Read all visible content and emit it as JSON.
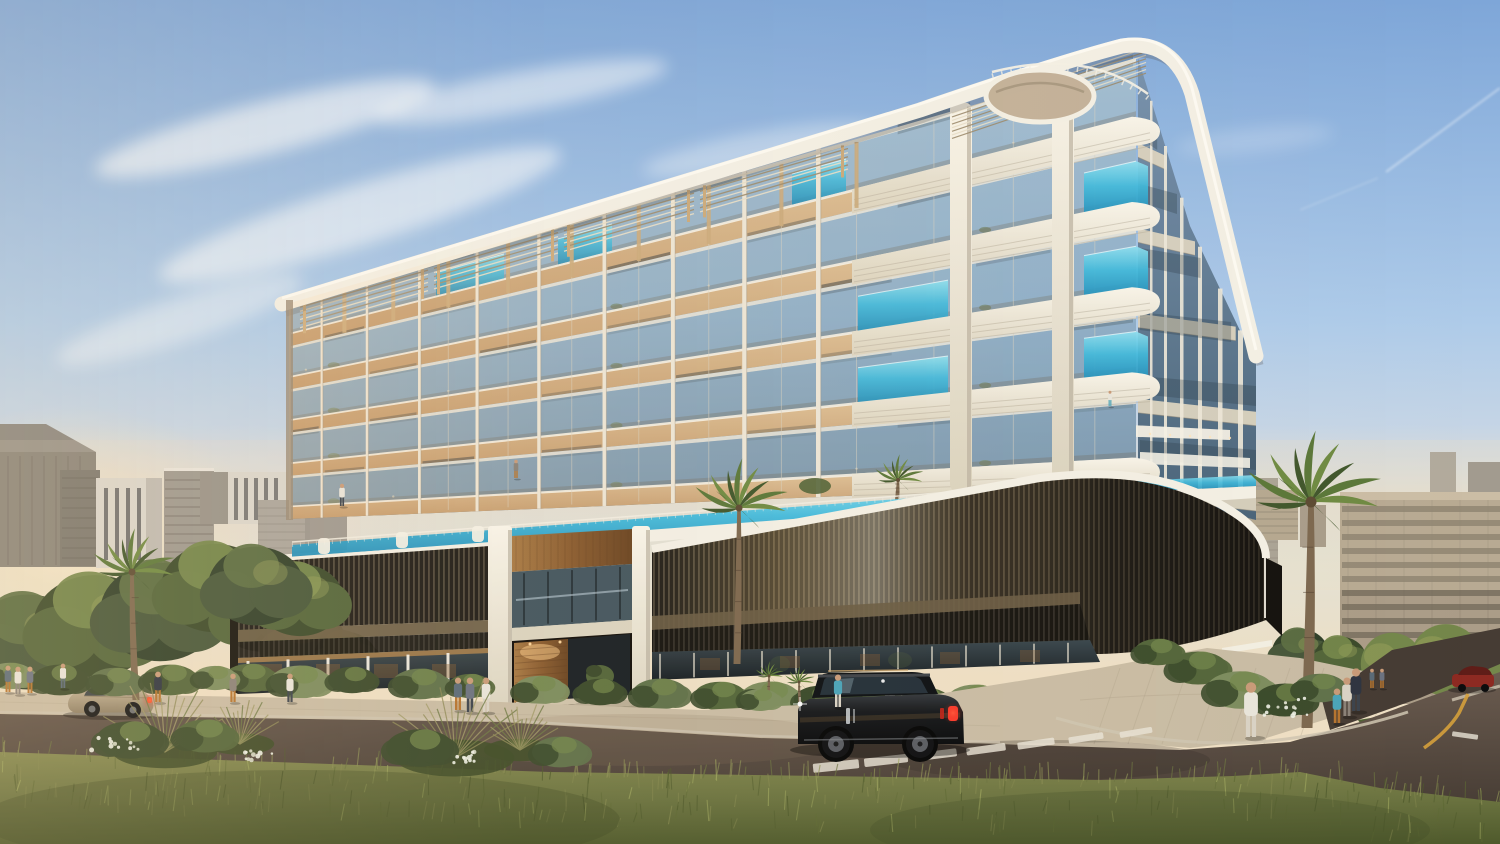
{
  "scene": {
    "type": "architectural-exterior-render",
    "subject": "modern luxury apartment building with balcony pools",
    "setting": "residential street corner, late afternoon sun from the left",
    "sky": "clear blue with thin cirrus clouds and a faint contrail"
  },
  "building": {
    "name": "main-apartment-building",
    "floors_visible": 5,
    "features": [
      "glass-balconies",
      "balcony-plunge-pools",
      "timber-slab-bands",
      "vertical-white-fins",
      "rounded-corner-balconies",
      "rooftop-pergolas",
      "curved-white-roof-canopy",
      "circular-roof-disc",
      "bronze-louvre-podium",
      "rooftop-pool-deck",
      "recessed-timber-entrance"
    ]
  },
  "vehicles": [
    {
      "name": "black-luxury-suv",
      "color": "#111315",
      "lights": "red-taillights-on"
    },
    {
      "name": "beige-wagon",
      "color": "#b9a98d",
      "lights": "red-taillights-on"
    },
    {
      "name": "dark-red-car",
      "color": "#8d2a22"
    }
  ],
  "vegetation": {
    "palm_trees": 4,
    "street_bushes": "dense shrubs with white flowers",
    "foreground": "tall olive-green grass meadow"
  },
  "pedestrians": {
    "count": 17,
    "outfits": [
      "#5a6a78",
      "#8a8178",
      "#c9556a",
      "#4aa3b8",
      "#e8e4da",
      "#6b7280",
      "#b5742f",
      "#2e3440",
      "#d9d2c4",
      "#3c434c"
    ]
  },
  "road": {
    "markings": [
      "white-crosswalk",
      "yellow-center-line",
      "white-stop-dash"
    ],
    "crosswalk_bar_count": 7
  },
  "palette": {
    "sky_top": "#7ea6d8",
    "sky_mid": "#aecbe9",
    "sky_low": "#cfd9e4",
    "sky_haze": "#e3e1d4",
    "sky_warm": "#eedfc4",
    "sun_glow": "#fff3d6",
    "cloud": "#ffffff",
    "skyline_dark": "#716f68",
    "skyline_mid": "#918e87",
    "skyline_light": "#d7d5cf",
    "skyline_side": "#b7b5b0",
    "skyline_win": "#41444a",
    "bg_beige": "#ab9d88",
    "bg_beige_dark": "#8e8171",
    "bg_win": "#564f42",
    "bg_glow": "#c8914d",
    "tree_dark": "#3b4a2b",
    "tree_mid": "#53653a",
    "tree_light": "#74874b",
    "tree_warm": "#9aa25c",
    "palm_dark": "#41572c",
    "palm_mid": "#5b7739",
    "palm_light": "#6f8a42",
    "palm_trunk": "#7d684f",
    "glass_hi": "#9db8d0",
    "glass": "#7da1c0",
    "glass_lo": "#58748c",
    "balustrade": "#a9c3d4",
    "wood_hi": "#e7cda4",
    "wood_lo": "#bd9468",
    "wood_soffit": "#c9a87a",
    "fin": "#ece6d8",
    "cream": "#f3efe4",
    "cream_shade": "#dbd3bf",
    "groove": "#b7ae9c",
    "pool_light": "#8fe0f0",
    "pool_aqua": "#3fb9dc",
    "pool_deep": "#1f8cb8",
    "louvre_dark": "#201d18",
    "louvre_line": "#7d7159",
    "louvre_dark2": "#15130f",
    "louvre_line2": "#4e4840",
    "wood_band": "#6b5d45",
    "ground_glass_hi": "#3a474d",
    "ground_glass_lo": "#181f23",
    "mullion": "#ded8c8",
    "interior_glow": "#8a5f33",
    "entry_wood_hi": "#a87a45",
    "entry_wood_lo": "#6b4522",
    "sidewalk": "#c9bca4",
    "paver": "#ab9e86",
    "road_hi": "#6b5c50",
    "road_lo": "#463c34",
    "curb": "#cfc5b2",
    "mark_white": "#e9e3d6",
    "mark_yellow": "#d5a03c",
    "grass_hi": "#83874e",
    "grass_mid": "#6b7340",
    "grass_lo": "#4f5a2c",
    "bush_sage": "#7c8c5e",
    "bush_dry": "#8f8a58",
    "flower": "#eef0e4",
    "suv_hi": "#34383d",
    "suv_mid": "#17191c",
    "suv_lo": "#0a0b0d",
    "suv_glass": "#10151a",
    "rim": "#5a5d63",
    "taillight": "#ff4330",
    "headlight": "#fff6e0",
    "car_beige_hi": "#cbbb9e",
    "car_beige_lo": "#8f8066",
    "car_red": "#8d2a22",
    "skin": "#c89a78"
  }
}
